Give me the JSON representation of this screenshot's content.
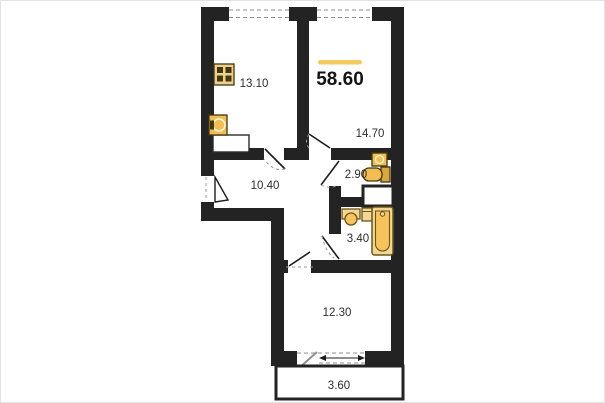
{
  "floor_plan": {
    "total_area_label": "58.60",
    "accent_color": "#F3CA5E",
    "wall_color": "#232323",
    "rooms": {
      "kitchen": {
        "area_label": "13.10"
      },
      "living_room": {
        "area_label": "14.70"
      },
      "hallway": {
        "area_label": "10.40"
      },
      "wc": {
        "area_label": "2.90"
      },
      "bathroom": {
        "area_label": "3.40"
      },
      "bedroom": {
        "area_label": "12.30"
      },
      "balcony": {
        "area_label": "3.60"
      }
    },
    "fixture_icons": [
      "stove-icon",
      "kitchen-sink-icon",
      "kitchen-counter",
      "wc-sink-icon",
      "toilet-icon",
      "ventilation-shaft",
      "bath-sink-icon",
      "washing-machine-icon",
      "bathtub-icon"
    ],
    "fixture_colors": {
      "stove_fill": "#EFCF8B",
      "gold_fill": "#F2BE52",
      "tub_fill": "#F2D695",
      "tub_bowl_fill": "#F7C35C",
      "fixture_stroke": "#6B5517"
    }
  }
}
